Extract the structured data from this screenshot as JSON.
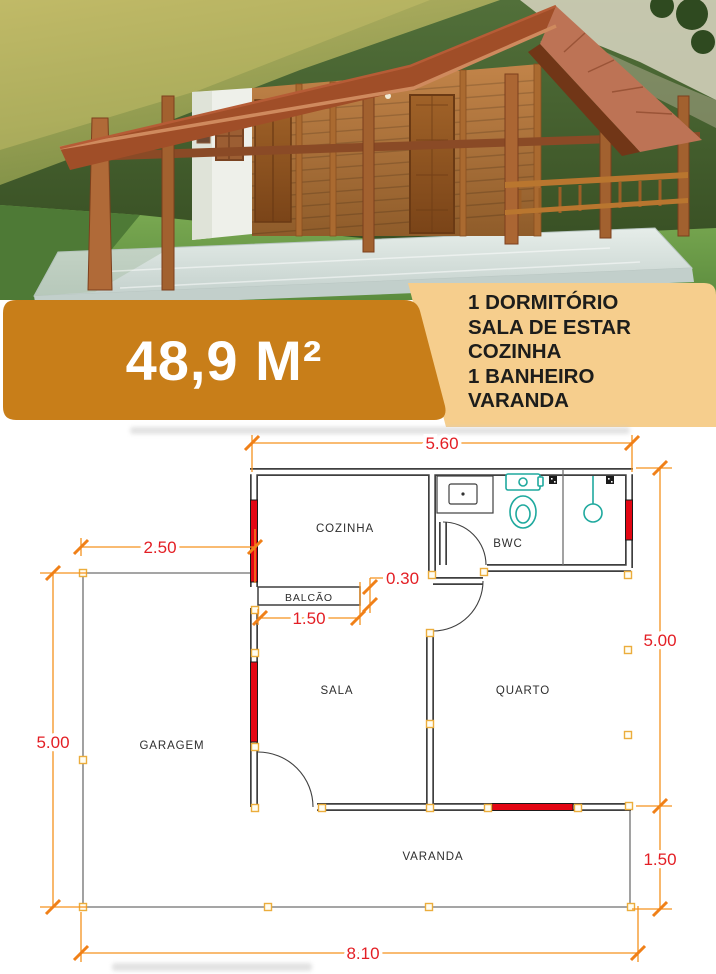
{
  "colors": {
    "banner_orange": "#C87E19",
    "panel_tan": "#F6CE8D",
    "dim_line_orange": "#F5921E",
    "dim_text_red": "#E31E24",
    "wall_dark": "#3F3F3F",
    "window_red": "#E30613",
    "column_gold": "#EBAD3C",
    "fixture_teal": "#1FA99E"
  },
  "banner": {
    "area_label": "48,9 M²"
  },
  "features": {
    "items": [
      "1 DORMITÓRIO",
      "SALA DE ESTAR",
      "COZINHA",
      "1 BANHEIRO",
      "VARANDA"
    ]
  },
  "floor_plan": {
    "rooms": {
      "cozinha": "COZINHA",
      "bwc": "BWC",
      "balcao": "BALCÃO",
      "sala": "SALA",
      "quarto": "QUARTO",
      "garagem": "GARAGEM",
      "varanda": "VARANDA"
    },
    "dimensions": {
      "top_width": "5.60",
      "garage_width": "2.50",
      "counter_depth": "0.30",
      "counter_width": "1.50",
      "left_height": "5.00",
      "right_height": "5.00",
      "varanda_depth": "1.50",
      "total_width": "8.10"
    },
    "fixtures": {
      "sink": "sink-icon",
      "toilet": "toilet-icon",
      "shower": "shower-icon",
      "floor_drain": "drain-icon"
    }
  }
}
